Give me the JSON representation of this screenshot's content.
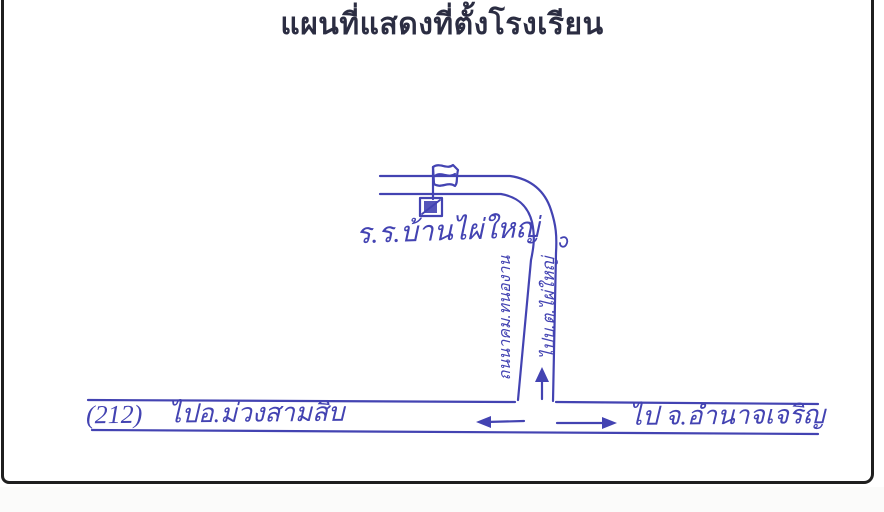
{
  "page": {
    "title": "แผนที่แสดงที่ตั้งโรงเรียน"
  },
  "map": {
    "school_label": "ร.ร.บ้านไผ่ใหญ่",
    "vertical_road_label_left": "ถนนาคม.ทนองาน",
    "vertical_road_label_right": "ไปบ.ต.ไผ่ใหญ่",
    "highway_number": "(212)",
    "west_direction_label": "ไปอ.ม่วงสามสิบ",
    "east_direction_label": "ไป จ.อำนาจเจริญ"
  },
  "colors": {
    "pen": "#4343b2",
    "title": "#2b2d42",
    "frame": "#1f1f1f",
    "paper": "#ffffff"
  }
}
